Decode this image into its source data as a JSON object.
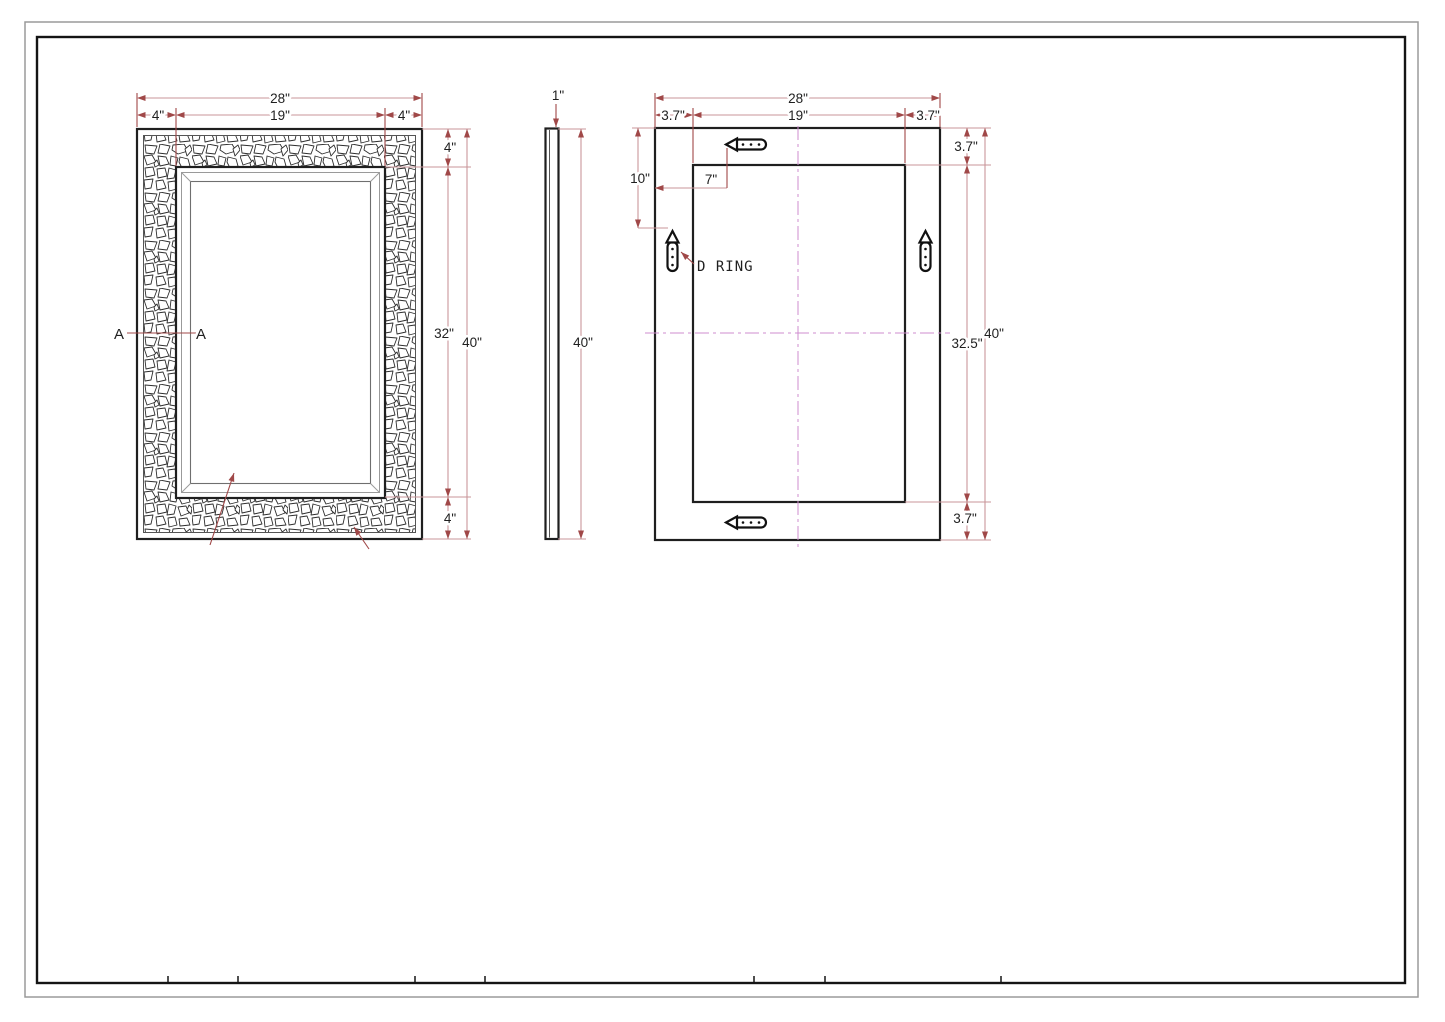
{
  "drawing": {
    "front": {
      "w_total": "28\"",
      "w_left": "4\"",
      "w_mid": "19\"",
      "w_right": "4\"",
      "h_top": "4\"",
      "h_mid": "32\"",
      "h_total": "40\"",
      "h_bottom": "4\"",
      "section_a_left": "A",
      "section_a_right": "A"
    },
    "side": {
      "thickness": "1\"",
      "height": "40\""
    },
    "back": {
      "w_total": "28\"",
      "w_left": "3.7\"",
      "w_mid": "19\"",
      "w_right": "3.7\"",
      "t_top": "3.7\"",
      "drop": "10\"",
      "inset": "7\"",
      "d_ring": "D RING",
      "h_mid": "32.5\"",
      "h_total": "40\"",
      "t_bottom": "3.7\""
    },
    "colors": {
      "line": "#1f1f1f",
      "dim_line": "#c9969a",
      "dim_accent": "#a04848",
      "centerline": "#cf8ccf"
    }
  }
}
